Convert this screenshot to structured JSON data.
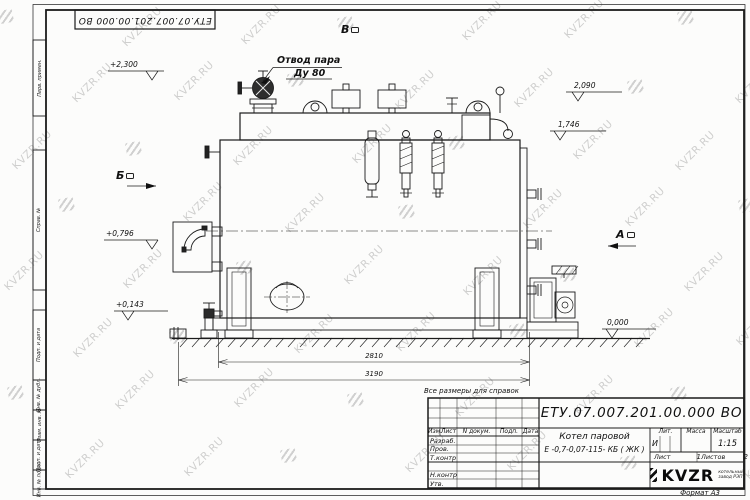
{
  "sheet": {
    "doc_number": "ЕТУ.07.007.201.00.000  ВО",
    "format_label": "Формат А3",
    "note": "Все размеры для справок",
    "margin_labels": [
      "Перв. примен.",
      "Справ. №",
      "Подп. и дата",
      "Инв. № дубл.",
      "Взам. инв. №",
      "Подп. и дата",
      "Инв. № подл."
    ]
  },
  "watermark": {
    "text": "KVZR.RU"
  },
  "annotations": {
    "steam_outlet": {
      "line1": "Отвод пара",
      "line2": "Ду 80"
    },
    "views": {
      "a": "А",
      "b": "Б",
      "v": "В"
    },
    "elevations": {
      "e_2300": "+2,300",
      "e_2090": "2,090",
      "e_1746": "1,746",
      "e_0796": "+0,796",
      "e_0143": "+0,143",
      "e_0000": "0,000"
    },
    "dimensions": {
      "overall_inner": "2810",
      "overall_outer": "3190"
    }
  },
  "titleblock": {
    "product_line1": "Котел паровой",
    "product_line2": "Е -0,7-0,07-115- КБ ( ЖК )",
    "change_header": {
      "izm": "Изм.",
      "list": "Лист",
      "doc": "N докум.",
      "sign": "Подп.",
      "date": "Дата"
    },
    "sig_rows": {
      "r1": "Разраб.",
      "r2": "Пров.",
      "r3": "Т.контр",
      "r4": "Н.контр",
      "r5": "Утв."
    },
    "lit_header": "Лит.",
    "mass_header": "Масса",
    "scale_header": "Масштаб",
    "lit_value": "И",
    "scale_value": "1:15",
    "sheet_label": "Лист",
    "sheet_value": "1",
    "sheets_label": "Листов",
    "sheets_value": "2",
    "logo": {
      "name": "KVZR",
      "sub1": "котельный",
      "sub2": "завод РЭП"
    }
  }
}
